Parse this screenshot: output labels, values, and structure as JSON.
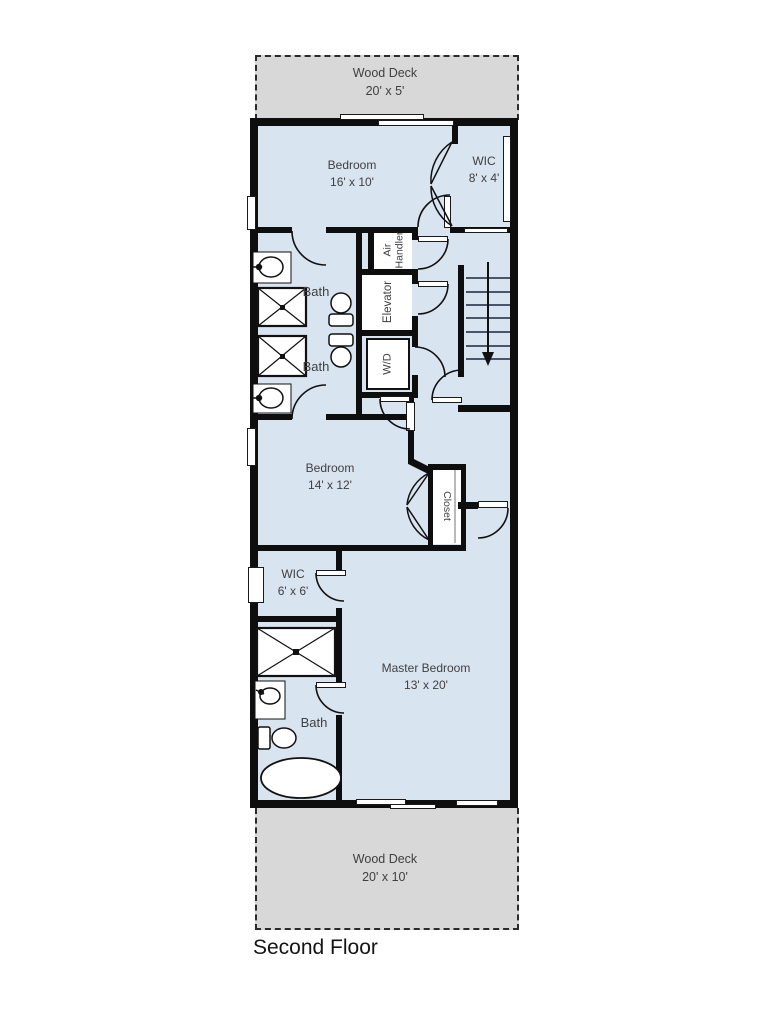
{
  "title": "Second Floor",
  "palette": {
    "room_fill": "#d9e4f1",
    "service_fill": "#ffffff",
    "deck_fill": "#d8d8d8",
    "wall": "#0e0e0e",
    "label": "#3f3f3f",
    "stair_tread": "#4a556b"
  },
  "decks": {
    "top": {
      "label": "Wood Deck",
      "dims": "20' x 5'"
    },
    "bottom": {
      "label": "Wood Deck",
      "dims": "20' x 10'"
    }
  },
  "rooms": {
    "bedroom1": {
      "label": "Bedroom",
      "dims": "16' x 10'"
    },
    "wic1": {
      "label": "WIC",
      "dims": "8' x 4'"
    },
    "bath1": {
      "label": "Bath"
    },
    "bath2": {
      "label": "Bath"
    },
    "air_handler": {
      "line1": "Air",
      "line2": "Handler"
    },
    "elevator": {
      "label": "Elevator"
    },
    "laundry": {
      "label": "W/D"
    },
    "bedroom2": {
      "label": "Bedroom",
      "dims": "14' x 12'"
    },
    "closet": {
      "label": "Closet"
    },
    "wic2": {
      "label": "WIC",
      "dims": "6' x 6'"
    },
    "master_bath": {
      "label": "Bath"
    },
    "master_bedroom": {
      "label": "Master Bedroom",
      "dims": "13' x 20'"
    }
  }
}
